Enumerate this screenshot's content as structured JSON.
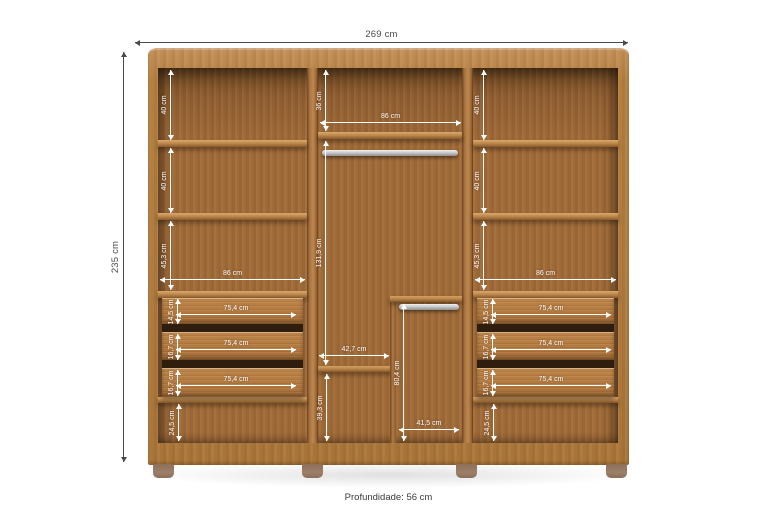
{
  "outer": {
    "width": "269 cm",
    "height": "235 cm",
    "depth": "Profundidade: 56 cm"
  },
  "left": {
    "sections": [
      "40 cm",
      "40 cm",
      "45,3 cm"
    ],
    "width": "86 cm",
    "drawer_heights": [
      "14,5 cm",
      "16,7 cm",
      "16,7 cm"
    ],
    "drawer_widths": [
      "75,4 cm",
      "75,4 cm",
      "75,4 cm"
    ],
    "bottom": "24,5 cm"
  },
  "middle": {
    "top": "36 cm",
    "width": "86 cm",
    "hanging": "131,9 cm",
    "shelf": "42,7 cm",
    "below_shelf": "39,3 cm",
    "rod_section_height": "80,4 cm",
    "rod_section_width": "41,5 cm"
  },
  "right": {
    "sections": [
      "40 cm",
      "40 cm",
      "45,3 cm"
    ],
    "width": "86 cm",
    "drawer_heights": [
      "14,5 cm",
      "16,7 cm",
      "16,7 cm"
    ],
    "drawer_widths": [
      "75,4 cm",
      "75,4 cm",
      "75,4 cm"
    ],
    "bottom": "24,5 cm"
  },
  "colors": {
    "frame_wood": "#b5803f",
    "interior_wood": "#a16b38",
    "drawer_wood": "#b3793f",
    "rod_metal": "#c9c9c9",
    "foot": "#9d8069",
    "dim_internal": "#ffffff",
    "dim_external": "#4a4a4a",
    "background": "#ffffff"
  }
}
